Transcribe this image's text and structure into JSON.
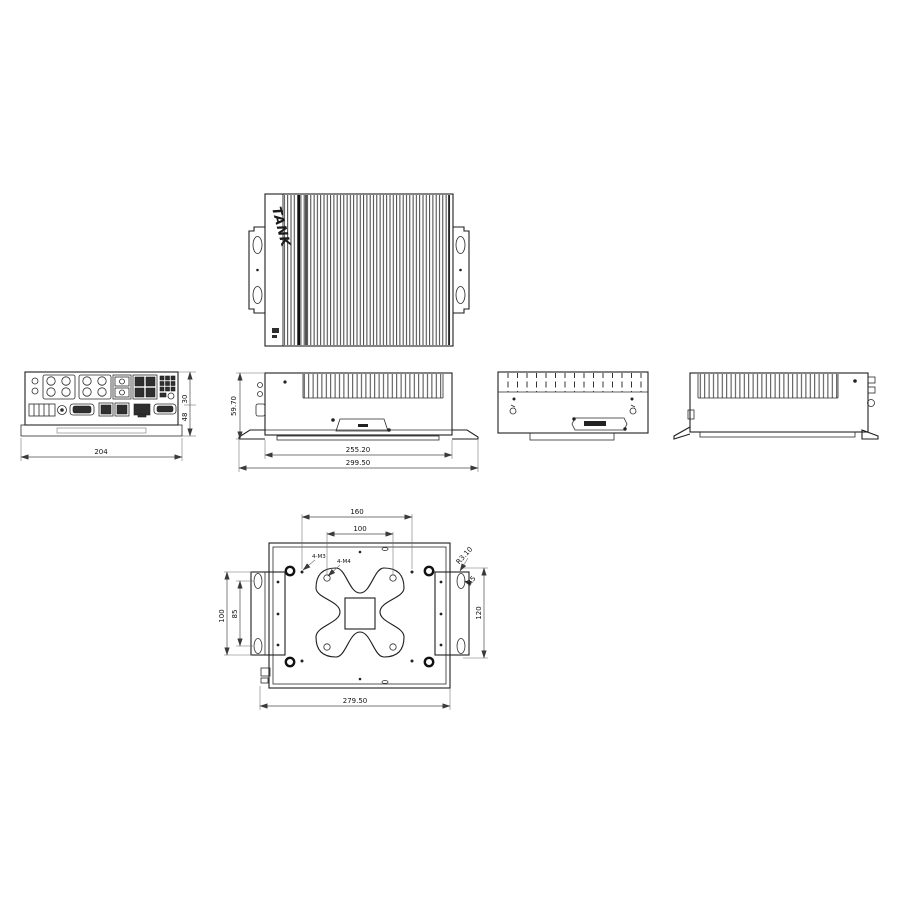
{
  "drawing": {
    "logo": "TANK",
    "front": {
      "overall_width": "204",
      "dim_upper": "30",
      "dim_lower": "48"
    },
    "side": {
      "overall_height": "59.70",
      "body_width": "255.20",
      "overall_width": "299.50"
    },
    "bottom": {
      "mount_hole_span": "160",
      "vesa_pitch": "100",
      "bracket_height": "100",
      "slot_pitch": "85",
      "right_pitch": "120",
      "corner_radius": "R3.10",
      "slot_radius": "R5",
      "overall_width": "279.50",
      "screw_callout_1": "4-M3",
      "screw_callout_2": "4-M4"
    }
  }
}
